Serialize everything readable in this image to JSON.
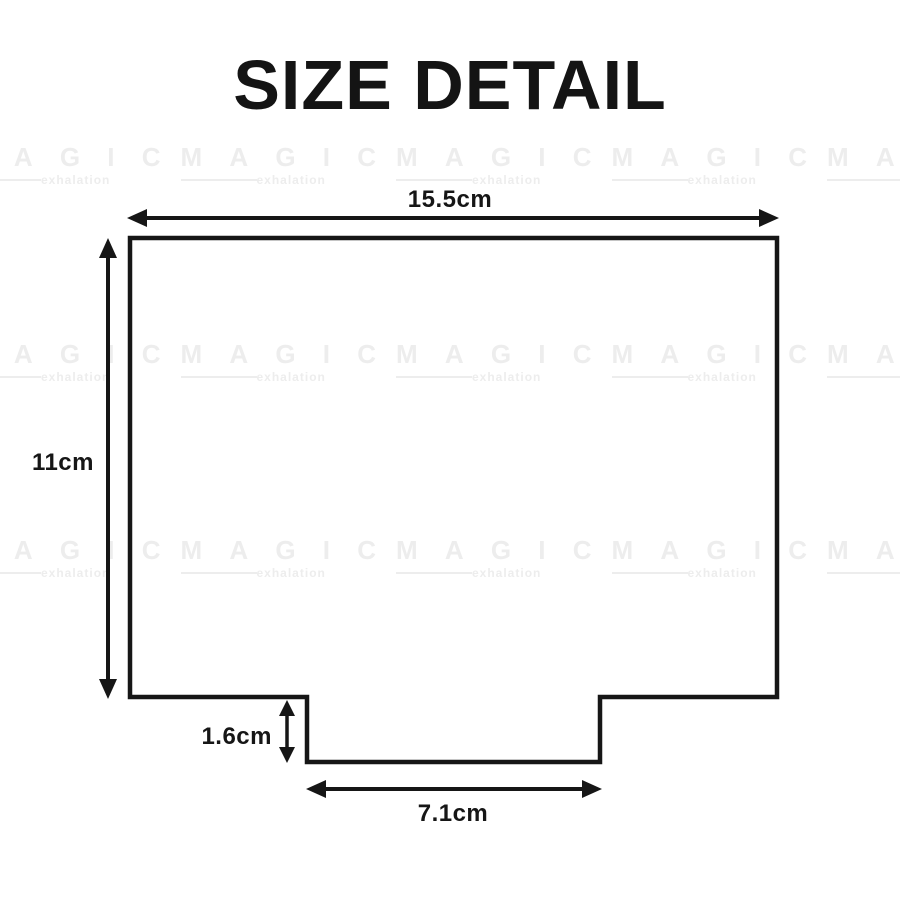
{
  "title": "SIZE DETAIL",
  "watermark": {
    "word": "MAGIC",
    "subtext": "exhalation",
    "color": "#ededed"
  },
  "colors": {
    "line": "#161616",
    "text": "#161616",
    "background": "#ffffff"
  },
  "diagram": {
    "shape": "rectangle with a centered tab protruding downward from the bottom edge",
    "dimensions": {
      "width": "15.5cm",
      "height": "11cm",
      "tab_depth": "1.6cm",
      "tab_width": "7.1cm"
    }
  }
}
